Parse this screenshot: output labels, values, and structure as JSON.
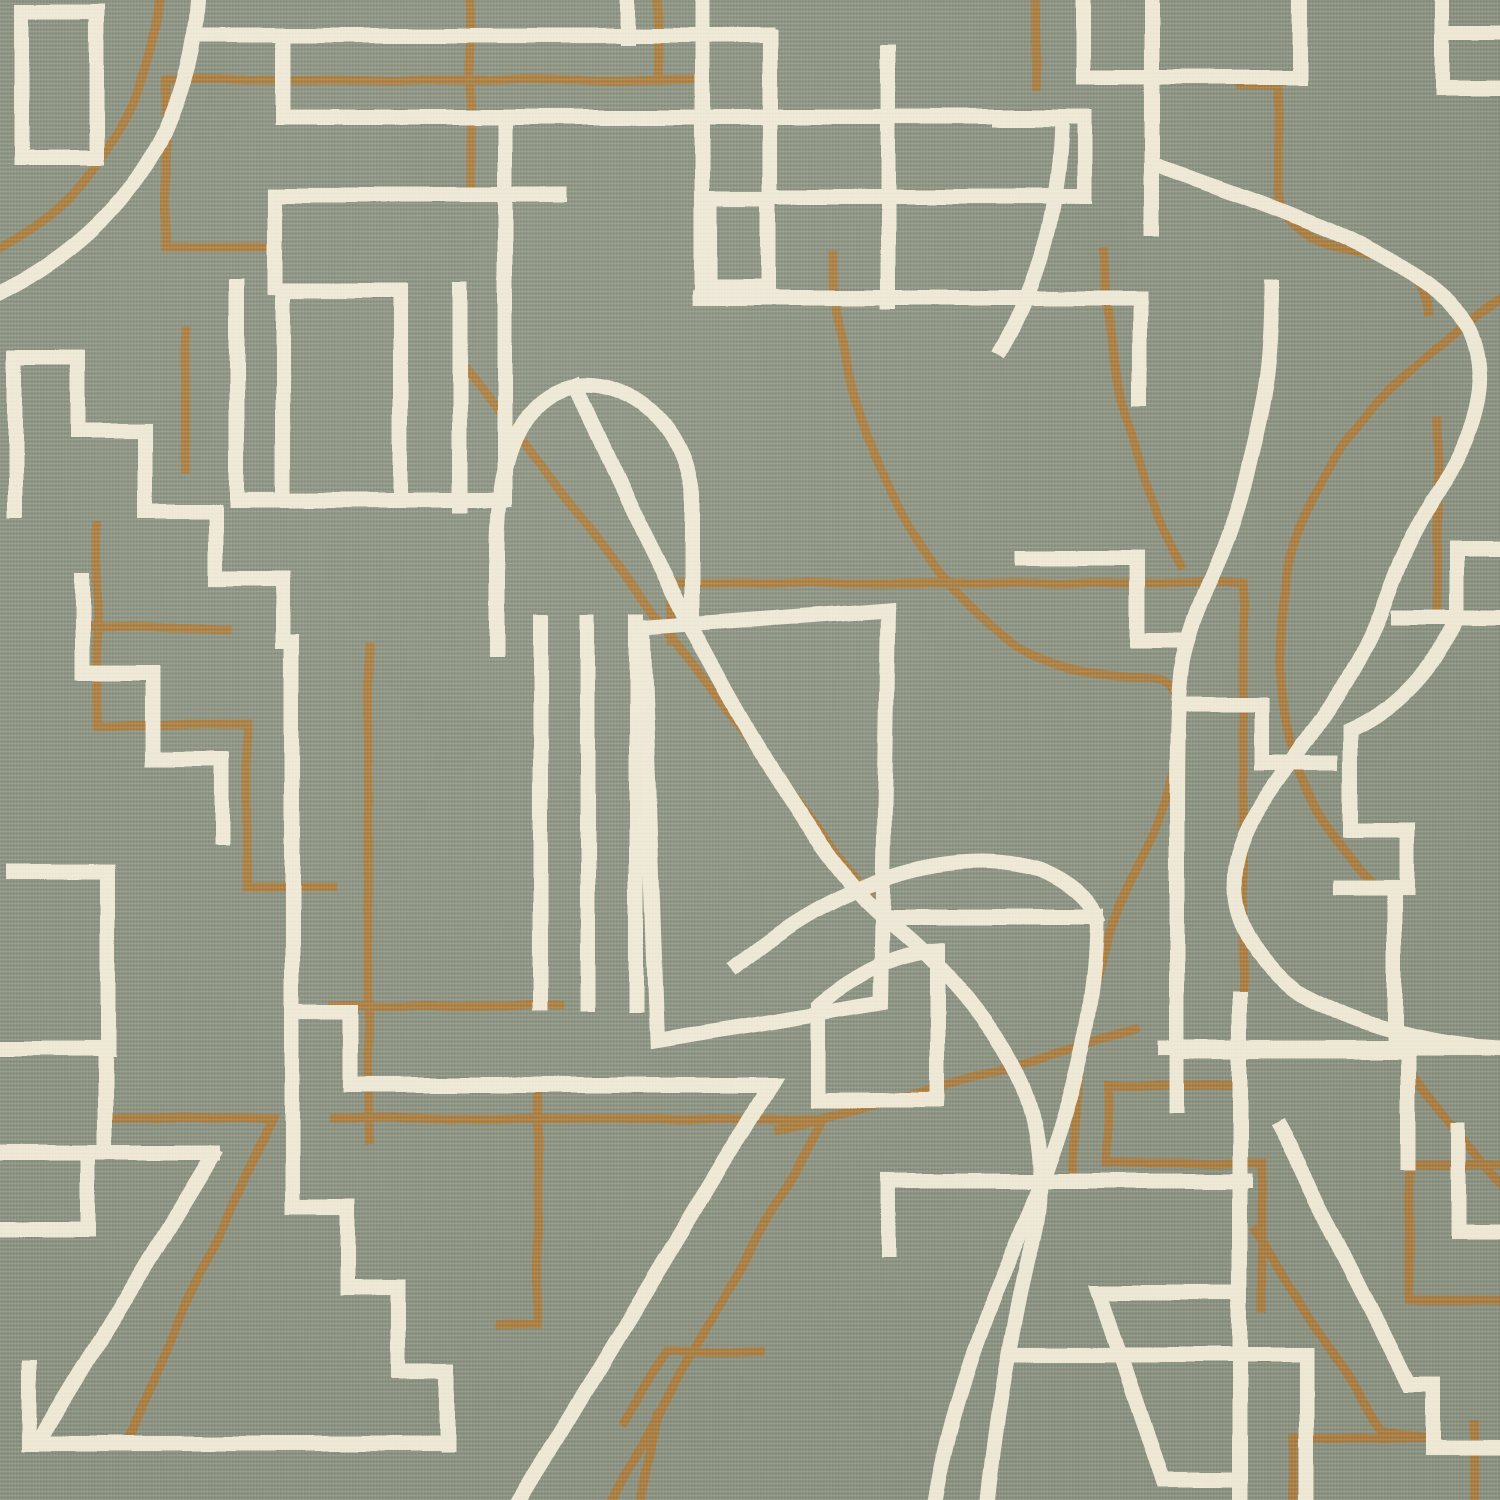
{
  "artwork": {
    "kind": "woven-textile-abstract-line-pattern",
    "canvas": {
      "width": 1500,
      "height": 1500
    },
    "palette": {
      "ground": "#8A9180",
      "ground_light": "#9BA38D",
      "ground_dark": "#6F7866",
      "cream": "#EDE6D4",
      "brown": "#A87C42"
    },
    "stroke": {
      "cream_width": 15,
      "brown_width": 9
    },
    "cream_paths": [
      {
        "id": "tl-rect",
        "d": "M22,158 V12 H97 V158 Z"
      },
      {
        "id": "tl-arc",
        "d": "M197,0 C190,115 135,225 0,293"
      },
      {
        "id": "top-horizontal-a",
        "d": "M197,35 H767"
      },
      {
        "id": "top-step-v",
        "d": "M283,35 V117"
      },
      {
        "id": "top-horizontal-b",
        "d": "M283,117 H1083"
      },
      {
        "id": "left-staircase",
        "d": "M15,510 V358 H78 V430 H145 V512 H215 V578 H283 V642 H292 V1207 H348 V1288 H398 V1370 H448 V1445"
      },
      {
        "id": "left-staircase-2",
        "d": "M82,580 V673 H153 V760 H222 V838"
      },
      {
        "id": "left-hook",
        "d": "M13,872 H108 V1048 H0"
      },
      {
        "id": "rect-top",
        "d": "M275,195 H560"
      },
      {
        "id": "rect-right",
        "d": "M505,195 V500"
      },
      {
        "id": "rect-left-bottom",
        "d": "M237,287 V500 H505"
      },
      {
        "id": "rect-left-upper",
        "d": "M275,195 V287"
      },
      {
        "id": "rect-inner",
        "d": "M283,497 V290 H400 V497"
      },
      {
        "id": "tick-bar",
        "d": "M460,290 V505"
      },
      {
        "id": "v505-up",
        "d": "M505,117 V195"
      },
      {
        "id": "center-h298",
        "d": "M700,298 H1140 V398"
      },
      {
        "id": "v702",
        "d": "M702,0 V298"
      },
      {
        "id": "v628",
        "d": "M628,0 V37"
      },
      {
        "id": "v770",
        "d": "M770,37 V197"
      },
      {
        "id": "small-square-top",
        "d": "M710,287 V200 H768 V287 Z"
      },
      {
        "id": "v888",
        "d": "M888,50 V302"
      },
      {
        "id": "h197",
        "d": "M770,197 H1085"
      },
      {
        "id": "v1085-link",
        "d": "M1085,117 V197"
      },
      {
        "id": "grid-h77",
        "d": "M1085,77 H1300"
      },
      {
        "id": "grid-v1152",
        "d": "M1152,0 V230"
      },
      {
        "id": "grid-v1083",
        "d": "M1083,0 V77"
      },
      {
        "id": "grid-v1300",
        "d": "M1300,0 V77"
      },
      {
        "id": "tr-seven",
        "d": "M1000,120 H1062 C1060,210 1038,285 1002,348"
      },
      {
        "id": "tr-corner",
        "d": "M1443,0 V88 H1500"
      },
      {
        "id": "tr-corner-2",
        "d": "M1448,32 H1500"
      },
      {
        "id": "right-bracket",
        "d": "M1500,550 H1457 V617 M1500,617 H1398"
      },
      {
        "id": "arch",
        "d": "M497,650 V550 C497,460 520,395 575,385 C632,378 685,425 692,495 V612"
      },
      {
        "id": "diagonal-fan",
        "d": "M575,385 C650,560 800,850 885,918 C940,960 1000,1030 1022,1085 C1043,1138 1046,1205 1028,1260 C1012,1330 996,1420 988,1500"
      },
      {
        "id": "fan-horizontal",
        "d": "M885,917 H1097"
      },
      {
        "id": "long-curve",
        "d": "M1272,288 C1272,345 1268,390 1250,460 C1230,555 1196,600 1183,660 C1177,700 1177,760 1177,820 V1105"
      },
      {
        "id": "lens-right",
        "d": "M1097,917 C1097,1030 1062,1140 1010,1258 C977,1333 948,1420 935,1500"
      },
      {
        "id": "cross-arc",
        "d": "M738,965 C840,880 950,845 1040,870 C1070,882 1090,900 1097,917"
      },
      {
        "id": "triple-bars",
        "d": "M540,622 V1005 M588,622 V1005 M637,622 V1005"
      },
      {
        "id": "center-quad",
        "d": "M643,628 L888,610 L881,1003 L658,1040 Z"
      },
      {
        "id": "curved-square",
        "d": "M818,1100 V1005 C858,972 898,953 937,950 V1100 Z"
      },
      {
        "id": "bottom-L",
        "d": "M888,1250 V1181 H1245"
      },
      {
        "id": "connector-step",
        "d": "M292,1013 H350 V1085 H458"
      },
      {
        "id": "big-seven",
        "d": "M455,1085 H770 L520,1500"
      },
      {
        "id": "bl-bars",
        "d": "M0,1048 H105 V1153 M0,1153 H213 M0,1230 H88 V1157"
      },
      {
        "id": "bl-seven",
        "d": "M213,1155 L40,1440 M30,1368 V1443 H448"
      },
      {
        "id": "right-stair",
        "d": "M1023,558 H1137 V640 H1183"
      },
      {
        "id": "right-steps-2",
        "d": "M1180,705 H1262 V763 H1330"
      },
      {
        "id": "great-s-curve",
        "d": "M1155,165 C1290,210 1430,262 1470,330 C1498,390 1462,455 1432,502 C1408,545 1398,565 1380,615 C1345,700 1285,765 1250,825 C1222,880 1230,940 1295,990 C1370,1032 1445,1046 1500,1048"
      },
      {
        "id": "br-h1048",
        "d": "M1165,1048 H1500"
      },
      {
        "id": "br-v1408",
        "d": "M1408,1048 V1163"
      },
      {
        "id": "br-v1240",
        "d": "M1240,1000 V1500"
      },
      {
        "id": "br-trapezoid",
        "d": "M1240,1293 H1100 L1163,1480 H1240"
      },
      {
        "id": "br-bar1355",
        "d": "M1012,1355 H1306 V1500"
      },
      {
        "id": "br-zigzag",
        "d": "M1280,1128 L1408,1385 H1433 V1448 H1500"
      },
      {
        "id": "br-bracket",
        "d": "M1458,1130 V1232 H1500"
      },
      {
        "id": "right-step-cluster",
        "d": "M1455,622 C1428,678 1390,712 1350,730 V830 H1407 V888 H1342 M1395,888 V1052 H1177"
      }
    ],
    "brown_paths": [
      {
        "id": "tl-arc-echo",
        "d": "M160,0 C151,96 96,198 0,248"
      },
      {
        "id": "tl-bracket",
        "d": "M697,80 H166 V247 H277"
      },
      {
        "id": "v470",
        "d": "M470,0 V192"
      },
      {
        "id": "v658",
        "d": "M658,0 V79"
      },
      {
        "id": "stair-v",
        "d": "M186,330 V468"
      },
      {
        "id": "stair-echo",
        "d": "M97,525 V725 H247 V887 H332"
      },
      {
        "id": "stair-bar",
        "d": "M93,627 H225"
      },
      {
        "id": "v368",
        "d": "M368,645 V1140"
      },
      {
        "id": "center-diagonal",
        "d": "M468,370 L868,895"
      },
      {
        "id": "quad-echo",
        "d": "M672,642 V583 H1243 V1085 H1107"
      },
      {
        "id": "quad-steps",
        "d": "M1107,1085 V1163 H1262 V1308"
      },
      {
        "id": "long-arc",
        "d": "M833,255 C842,425 905,565 1015,645 C1090,688 1145,672 1162,680 C1200,700 1175,790 1132,880 C1090,970 1074,1080 1072,1178"
      },
      {
        "id": "right-arc-echo",
        "d": "M1500,300 C1402,372 1302,452 1284,600 C1270,722 1302,812 1372,882"
      },
      {
        "id": "tr-curve",
        "d": "M1240,85 H1278 V190 C1283,235 1330,248 1380,257 C1412,264 1424,286 1428,312"
      },
      {
        "id": "v1035",
        "d": "M1035,0 V85"
      },
      {
        "id": "bl-horizontal",
        "d": "M333,1006 H560"
      },
      {
        "id": "bl-seven-echo",
        "d": "M112,1118 H272 L126,1440"
      },
      {
        "id": "big-seven-echo",
        "d": "M333,1118 H823 L612,1500"
      },
      {
        "id": "small-arrow",
        "d": "M760,1352 H668 L625,1420 M658,1415 L640,1500"
      },
      {
        "id": "br-zig-echo",
        "d": "M1255,1230 L1380,1430 L1436,1440 M1293,1500 V1438 H1436"
      },
      {
        "id": "br-steps-echo",
        "d": "M1500,1165 H1410 V1300 H1500"
      },
      {
        "id": "br-v1473",
        "d": "M1473,1425 V1500"
      },
      {
        "id": "arc-1103",
        "d": "M1103,252 C1108,360 1135,480 1180,565"
      },
      {
        "id": "v1437",
        "d": "M1437,420 V610"
      },
      {
        "id": "bl-bracket-echo",
        "d": "M537,1088 V1325 H500"
      },
      {
        "id": "under-square",
        "d": "M778,1128 C880,1105 1010,1070 1135,1028"
      },
      {
        "id": "br-diagonal",
        "d": "M1415,1080 L1500,1185"
      }
    ]
  }
}
